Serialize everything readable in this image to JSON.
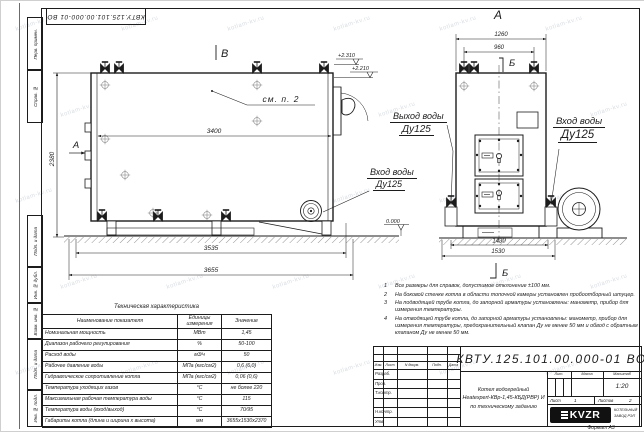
{
  "doc_number": "КВТУ.125.101.00.000-01 ВО",
  "watermark": "kotlam-kv.ru",
  "frame_labels": [
    "Перв. примен.",
    "Справ. №",
    "Подп. и дата",
    "Инв. № дубл.",
    "Взам. инв. №",
    "Подп. и дата",
    "Инв. № подл."
  ],
  "markers": {
    "a": "А",
    "b": "В",
    "sec": "Б"
  },
  "side": {
    "see_note": "см. п. 2",
    "dim_top": "3400",
    "dim_height": "2380",
    "dim_base": "3535",
    "dim_overall": "3655",
    "elev_high": "+2.310",
    "elev_mid": "+2.210",
    "elev_zero": "0.000",
    "inlet_1": "Вход воды",
    "inlet_2": "Ду125"
  },
  "front": {
    "dim_top": "1260",
    "dim_top2": "960",
    "dim_base": "1430",
    "dim_overall": "1530",
    "outlet_1": "Выход воды",
    "outlet_2": "Ду125",
    "inlet_1": "Вход воды",
    "inlet_2": "Ду125"
  },
  "tech": {
    "title": "Техническая характеристика",
    "headers": [
      "Наименование показателя",
      "Единицы измерения",
      "Значение"
    ],
    "rows": [
      [
        "Номинальная мощность",
        "МВт",
        "1,45"
      ],
      [
        "Диапазон рабочего регулирования",
        "%",
        "50-100"
      ],
      [
        "Расход воды",
        "м3/ч",
        "50"
      ],
      [
        "Рабочее давление воды",
        "МПа (кгс/см2)",
        "0,6 (6,0)"
      ],
      [
        "Гидравлическое сопротивление котла",
        "МПа (кгс/см2)",
        "0,06 (0,6)"
      ],
      [
        "Температура уходящих газов",
        "°С",
        "не более 220"
      ],
      [
        "Максимальная рабочая температура воды",
        "°С",
        "115"
      ],
      [
        "Температура воды (вход/выход)",
        "°С",
        "70/95"
      ],
      [
        "Габариты котла (длина и ширина х высота)",
        "мм",
        "3655х1530х2370"
      ]
    ]
  },
  "notes": [
    {
      "n": "1",
      "t": "Все размеры для справок, допустимое отклонение ±100 мм."
    },
    {
      "n": "2",
      "t": "На боковой стенке котла в области топочной камеры установлен пробоотборный штуцер."
    },
    {
      "n": "3",
      "t": "На подводящей трубе котла, до запорной арматуры установлены: манометр, прибор для измерения температуры."
    },
    {
      "n": "4",
      "t": "На отводящей трубе котла, до запорной арматуры установлены: манометр, прибор для измерения температуры, предохранительный клапан Ду не менее 50 мм и обвод с обратным клапаном Ду не менее 50 мм."
    }
  ],
  "stamp": {
    "cols": [
      "Изм.",
      "Лист",
      "N докум.",
      "Подп.",
      "Дата"
    ],
    "roles": [
      "Разраб.",
      "Пров.",
      "Т.контр.",
      "",
      "Н.контр.",
      "Утв."
    ],
    "product": [
      "Котел водогрейный",
      "Heatexpert-КВр-1,45-КБД(РВР) И",
      "по техническому заданию"
    ],
    "lit": "Лит.",
    "mass": "Масса",
    "scale_lbl": "Масштаб",
    "scale": "1:20",
    "sheet_lbl": "Лист",
    "sheet": "1",
    "sheets_lbl": "Листов",
    "sheets": "2",
    "logo": "KVZR",
    "logo_sub1": "КОТЕЛЬНЫЙ",
    "logo_sub2": "ЗАВОД РЭП",
    "format": "Формат А3"
  }
}
